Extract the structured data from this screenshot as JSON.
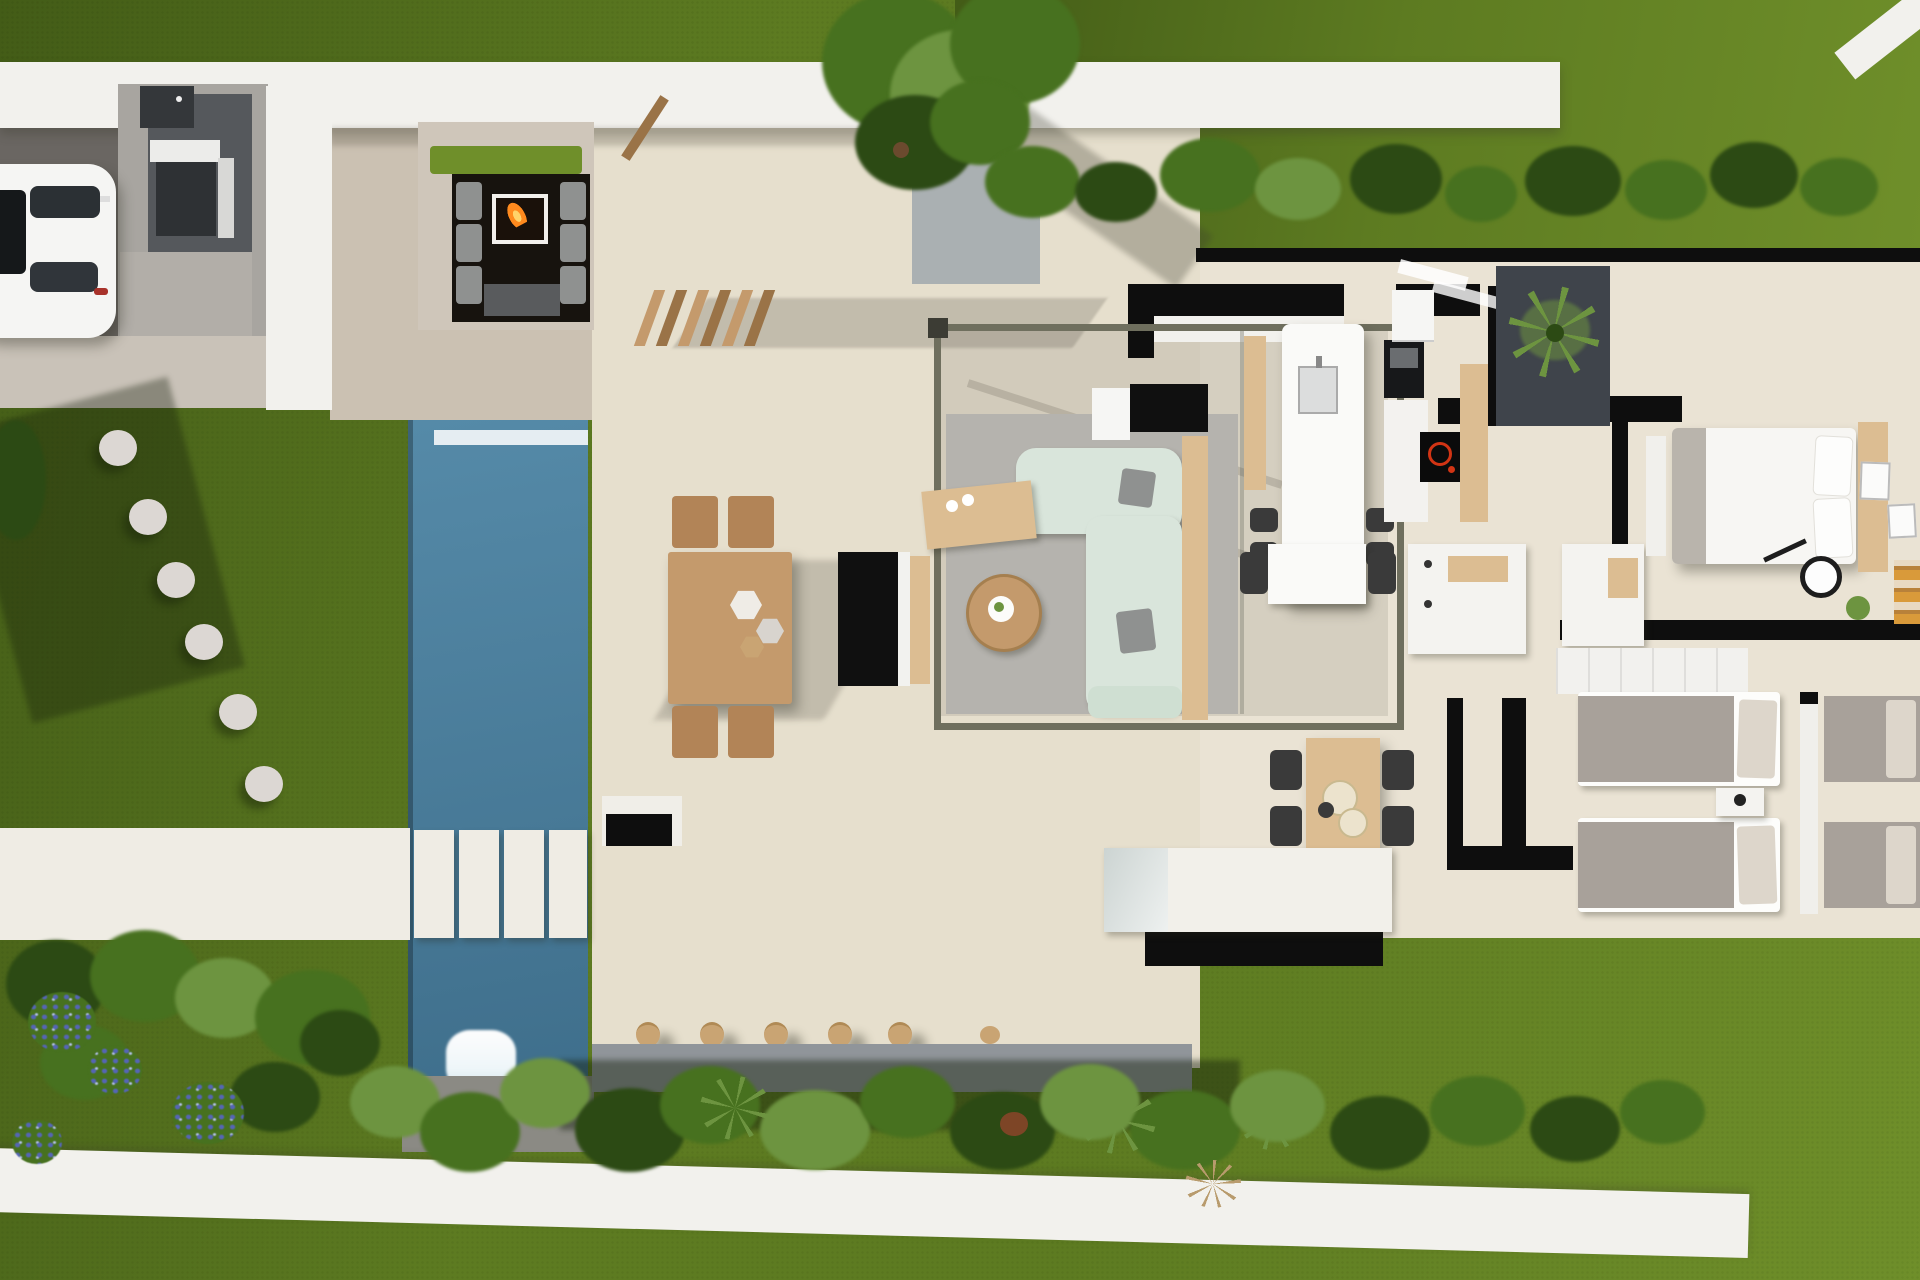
{
  "scene": {
    "title": "aerial-top-down-3d-render-of-modern-villa-plot",
    "view": "top-down",
    "areas": [
      "garden-lawn",
      "driveway",
      "carport-car",
      "outdoor-kitchen-bbq",
      "sunken-fire-pit-lounge",
      "pool-deck",
      "swimming-pool",
      "pool-waterfall",
      "pool-cross-slabs",
      "stepping-stone-path",
      "outdoor-terrace",
      "pergola-lounge",
      "outdoor-dining-set",
      "tree-with-gravel-bed",
      "kitchen-island",
      "kitchen-run",
      "interior-dining-set",
      "bathroom-vanity",
      "master-bedroom",
      "twin-bedroom",
      "second-twin-bedroom",
      "interior-courtyard-palm",
      "rear-porch",
      "planting-beds",
      "hydrangea-shrubs",
      "perimeter-walls"
    ],
    "objects": {
      "cars": 1,
      "stepping_stones": 6,
      "pool_cross_slabs": 4,
      "terrace_pots": 5,
      "fire_pits": 1,
      "waterfalls": 1,
      "outdoor_dining_chairs": 4,
      "indoor_dining_chairs": 4,
      "bar_stools": 4,
      "double_beds": 1,
      "twin_beds": 4,
      "palm_courtyards": 1
    }
  },
  "palette": {
    "grass": "#5d7b21",
    "grass_dark": "#435c17",
    "grass_bright": "#6f8f2a",
    "wall_white": "#f2f1ed",
    "terrace": "#e6dfcd",
    "deck": "#cbc1b2",
    "floor": "#eae3d4",
    "pool_a": "#558aa8",
    "pool_b": "#3f6f8c",
    "slab": "#efece4",
    "black_wall": "#0e0e0e",
    "rug": "#b5b3ae",
    "sofa": "#d9e5db",
    "sofa_arm": "#cfdfd2",
    "cushion": "#8f9190",
    "wood": "#c49a6c",
    "wood_light": "#dcbd92",
    "wood_dark": "#9a7347",
    "chair_wood": "#b28457",
    "pure_white": "#fafaf8",
    "stool": "#3a3a3a",
    "bed_white": "#f7f6f3",
    "bed_gray": "#a8a19a",
    "pillow_beige": "#ddd6cb",
    "fire": "#ff8a1e",
    "fire_core": "#ffd26a",
    "plant": "#47711f",
    "plant_dark": "#2c4a14",
    "plant_light": "#6d9440",
    "flower_blue": "#5565b5",
    "gravel": "#aab0b2",
    "gravel_dark": "#3f444b",
    "stone": "#dcd7d3",
    "pot_tan": "#c9a473",
    "pot_rust": "#7d4526",
    "concrete": "#a8a5a0",
    "drive_dark": "#6a6662",
    "apron": "#c9c2b8",
    "garage_dark": "#55585c",
    "bbq_dark": "#2e3134",
    "glass": "#ccd4d2",
    "water_white": "#eef6f9",
    "pit_dark": "#17130e",
    "tv_black": "#101010",
    "frame_olive": "#6f6f5e",
    "hob_red": "#d23414"
  }
}
